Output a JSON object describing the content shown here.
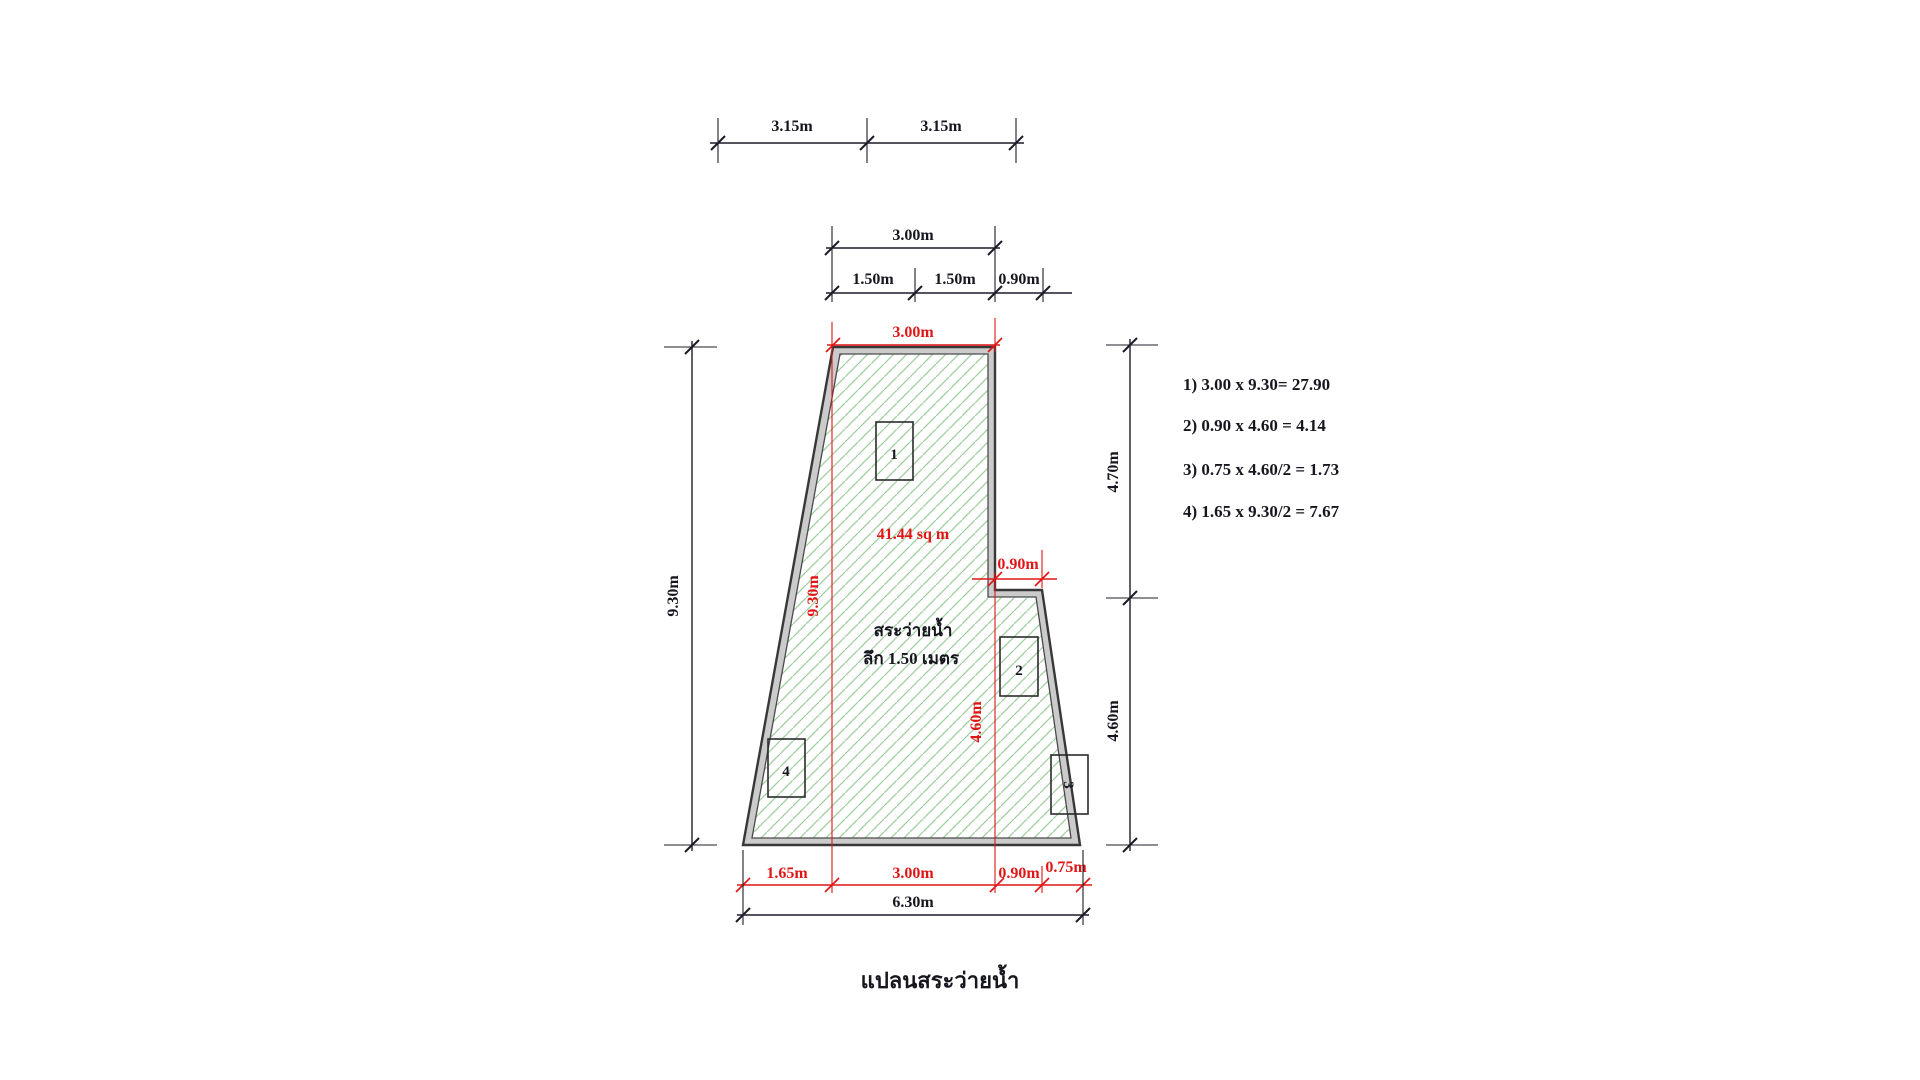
{
  "title": "แปลนสระว่ายน้ำ",
  "pool": {
    "area": "41.44 sq m",
    "name": "สระว่ายน้ำ",
    "depth": "ลึก 1.50 เมตร",
    "regions": [
      "1",
      "2",
      "3",
      "4"
    ]
  },
  "dims": {
    "overall_top": [
      "3.15m",
      "3.15m"
    ],
    "top_width": "3.00m",
    "top_split": [
      "1.50m",
      "1.50m",
      "0.90m"
    ],
    "top_red": "3.00m",
    "left_height": "9.30m",
    "left_height_red": "9.30m",
    "right_upper": "4.70m",
    "right_lower": "4.60m",
    "center_red": "4.60m",
    "step_red": "0.90m",
    "bottom_red": [
      "1.65m",
      "3.00m",
      "0.90m",
      "0.75m"
    ],
    "bottom_overall": "6.30m"
  },
  "calculations": [
    "1) 3.00 x 9.30= 27.90",
    "2) 0.90 x 4.60 = 4.14",
    "3) 0.75 x 4.60/2 = 1.73",
    "4) 1.65 x 9.30/2 = 7.67"
  ],
  "colors": {
    "dimension_red": "#e01616",
    "line_black": "#1c1c28",
    "hatch_green": "#9fd09f",
    "wall_fill": "#cbcbcb",
    "wall_outline": "#383838"
  }
}
